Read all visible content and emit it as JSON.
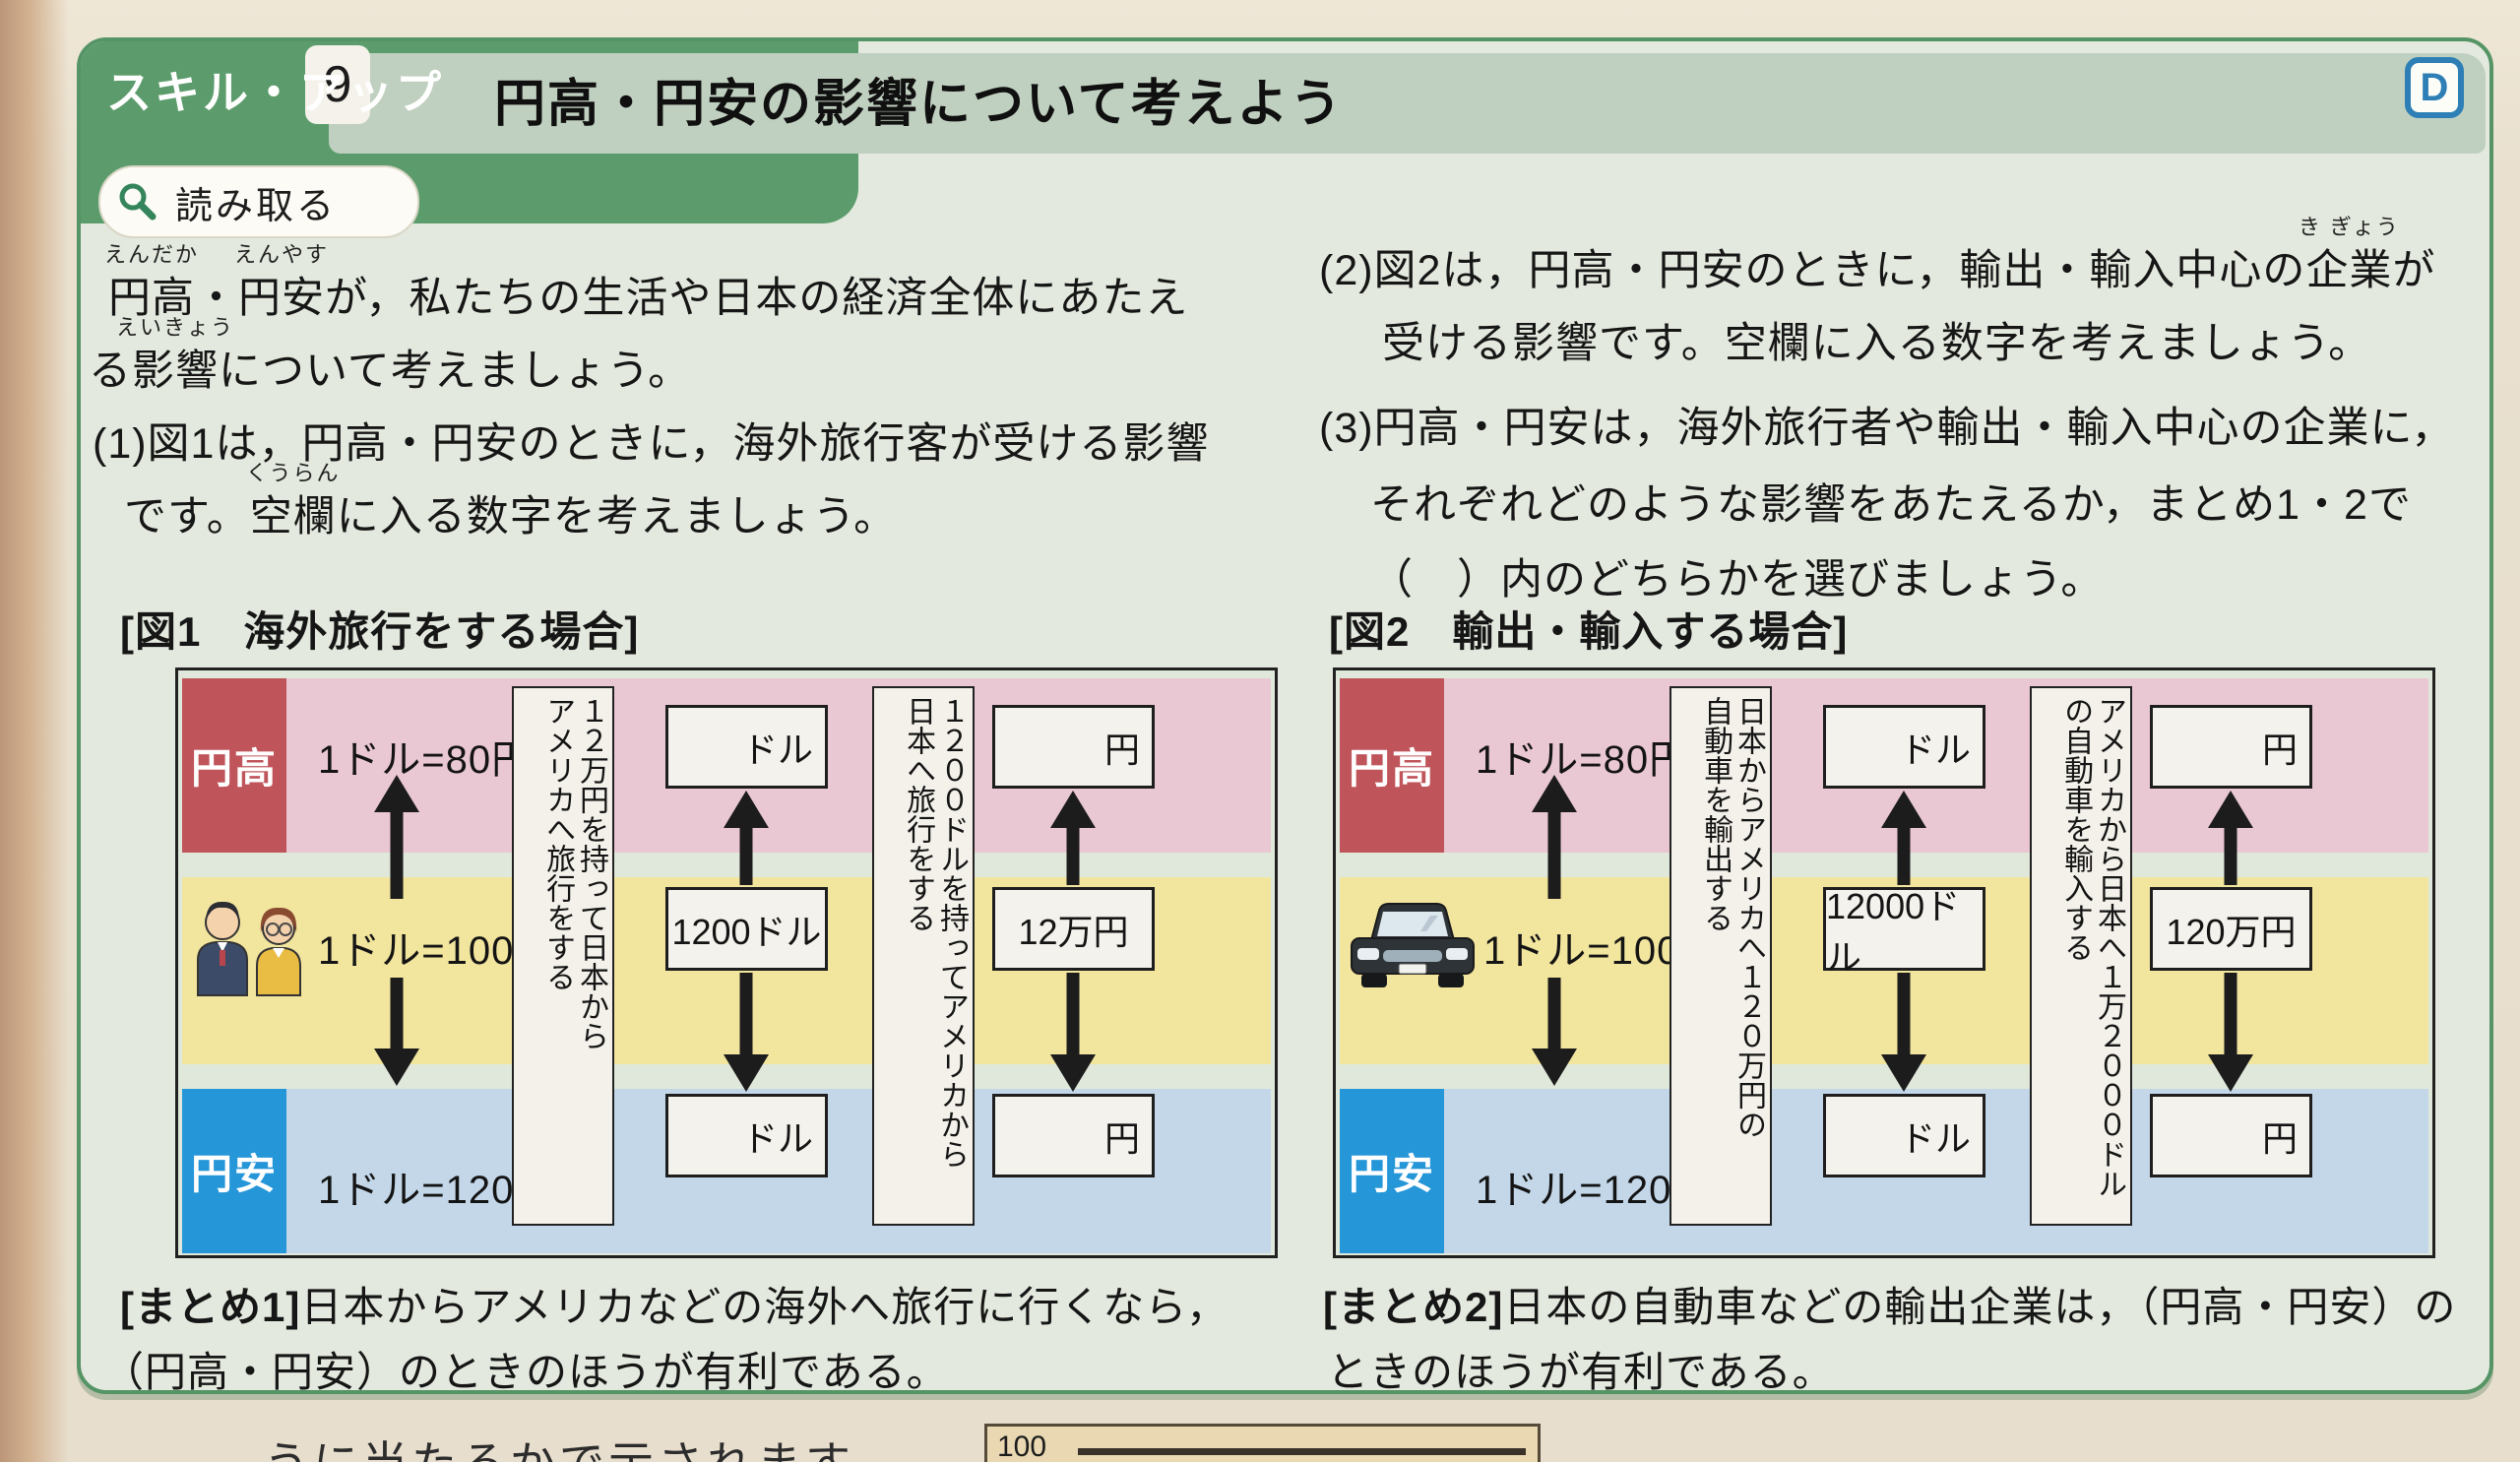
{
  "page": {
    "badge": "スキル・アップ",
    "badge_number": "9",
    "tool_label": "読み取る",
    "title": "円高・円安の影響について考えよう",
    "corner_icon": "D"
  },
  "intro": {
    "ruby1_base": "円高",
    "ruby1_rt": "えんだか",
    "sep1": "・",
    "ruby2_base": "円安",
    "ruby2_rt": "えんやす",
    "line1_rest": "が，私たちの生活や日本の経済全体にあたえ",
    "line2_pre": "る",
    "ruby3_base": "影響",
    "ruby3_rt": "えいきょう",
    "line2_rest": "について考えましょう。"
  },
  "q1": {
    "line1": "(1)図1は，円高・円安のときに，海外旅行客が受ける影響",
    "line2_pre": "です。",
    "ruby_base": "空欄",
    "ruby_rt": "くうらん",
    "line2_rest": "に入る数字を考えましょう。"
  },
  "q2": {
    "line1_pre": "(2)図2は，円高・円安のときに，輸出・輸入中心の",
    "ruby_base": "企業",
    "ruby_rt": "き ぎょう",
    "line1_rest": "が",
    "line2": "受ける影響です。空欄に入る数字を考えましょう。"
  },
  "q3": {
    "line1": "(3)円高・円安は，海外旅行者や輸出・輸入中心の企業に，",
    "line2": "それぞれどのような影響をあたえるか，まとめ1・2で",
    "line3": "（　）内のどちらかを選びましょう。"
  },
  "fig1": {
    "heading": "[図1　海外旅行をする場合]",
    "band_high_label": "円高",
    "band_high_rate": "1ドル=80円",
    "band_mid_rate": "1ドル=100円",
    "band_low_label": "円安",
    "band_low_rate": "1ドル=120円",
    "strip1_col1": "１２万円を持って日本から",
    "strip1_col2": "アメリカへ旅行をする",
    "col1_top_unit": "ドル",
    "col1_mid_value": "1200ドル",
    "col1_bottom_unit": "ドル",
    "strip2_col1": "１２００ドルを持ってアメリカから",
    "strip2_col2": "日本へ旅行をする",
    "col2_top_unit": "円",
    "col2_mid_value": "12万円",
    "col2_bottom_unit": "円"
  },
  "fig2": {
    "heading": "[図2　輸出・輸入する場合]",
    "band_high_label": "円高",
    "band_high_rate": "1ドル=80円",
    "band_mid_rate": "1ドル=100円",
    "band_low_label": "円安",
    "band_low_rate": "1ドル=120円",
    "strip1_col1": "日本からアメリカへ１２０万円の",
    "strip1_col2": "自動車を輸出する",
    "col1_top_unit": "ドル",
    "col1_mid_value": "12000ドル",
    "col1_bottom_unit": "ドル",
    "strip2_col1": "アメリカから日本へ１万２０００ドル",
    "strip2_col2": "の自動車を輸入する",
    "col2_top_unit": "円",
    "col2_mid_value": "120万円",
    "col2_bottom_unit": "円"
  },
  "summary1": {
    "tag": "[まとめ1]",
    "line1": "日本からアメリカなどの海外へ旅行に行くなら，",
    "line2": "（円高・円安）のときのほうが有利である。"
  },
  "summary2": {
    "tag": "[まとめ2]",
    "line1": "日本の自動車などの輸出企業は，（円高・円安）の",
    "line2": "ときのほうが有利である。"
  },
  "bottom": {
    "partial_text": "うに当たるかで示されます",
    "chart_label": "100"
  },
  "colors": {
    "header_green": "#5c9c6c",
    "title_band": "#c0d0c0",
    "panel_border": "#559465",
    "pink_band": "#eac8d3",
    "red_label": "#bf545a",
    "yellow_band": "#f2e59e",
    "blue_band": "#c3d7e9",
    "blue_label": "#2596d8",
    "d_icon_blue": "#2e7fb5"
  }
}
